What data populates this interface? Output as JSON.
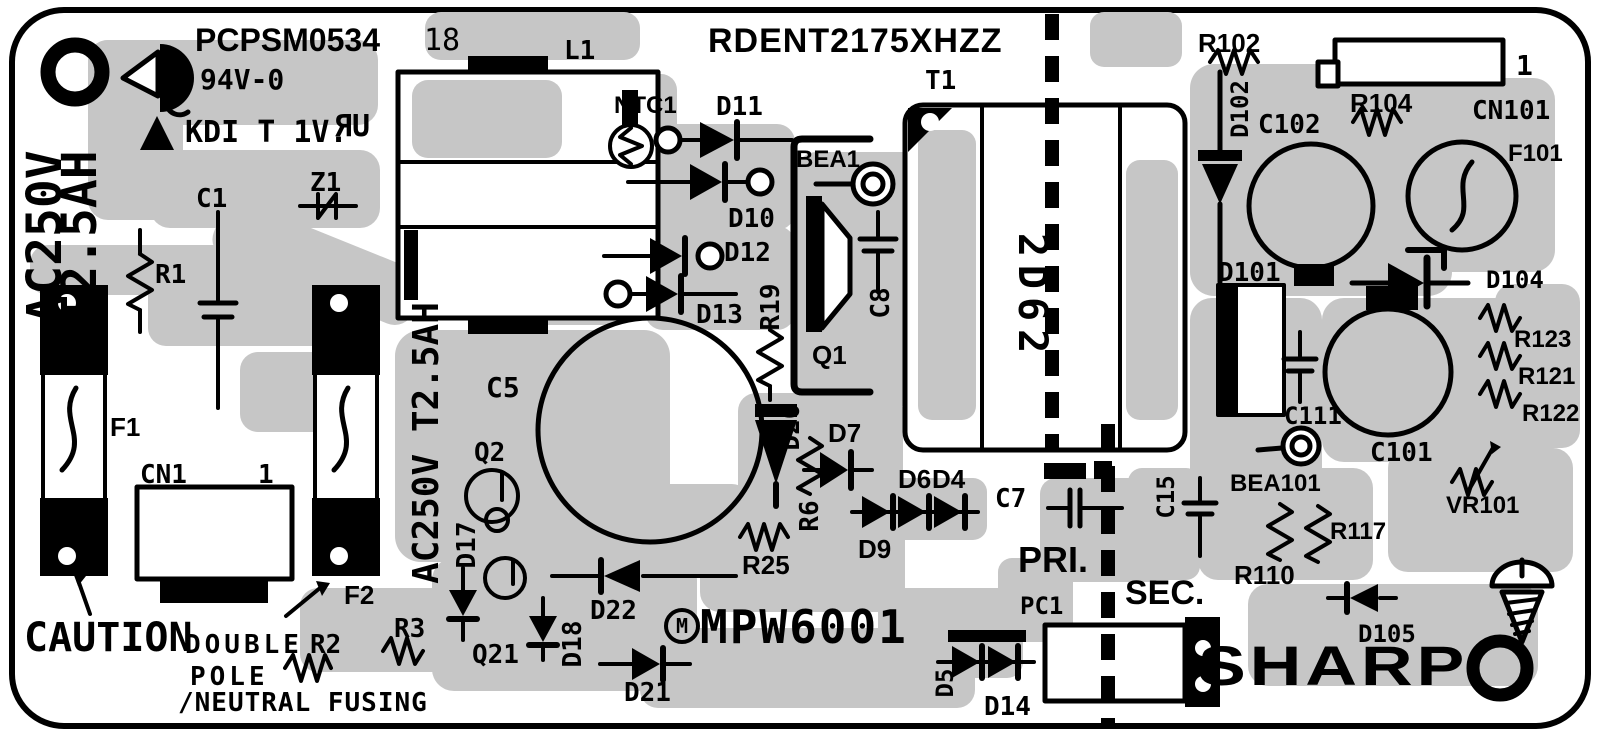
{
  "colors": {
    "copper": "#c6c6c6",
    "silkscreen": "#000000",
    "board": "#ffffff"
  },
  "header": {
    "part_number": "PCPSM0534",
    "revision": "18",
    "flammability_rating": "94V-0",
    "marking": "KDI T 1V.",
    "ul_mark": "ЯU",
    "model": "RDENT2175XHZZ"
  },
  "safety": {
    "caution": "CAUTION",
    "fusing_note_line1": "DOUBLE",
    "fusing_note_line2": "POLE",
    "fusing_note_line3": "/NEUTRAL FUSING",
    "fuse_rating_line1": "AC250V",
    "fuse_rating_line2": "T2.5AH",
    "fuse_rating_inline": "AC250V T2.5AH",
    "primary_side": "PRI.",
    "secondary_side": "SEC."
  },
  "ic": {
    "logo_letter": "M",
    "part": "MPW6001"
  },
  "transformer_marking": "2D62",
  "brand": "SHARP",
  "refs": {
    "c1": "C1",
    "z1": "Z1",
    "r1": "R1",
    "f1": "F1",
    "cn1": "CN1",
    "cn1_pin1": "1",
    "f2": "F2",
    "r2": "R2",
    "r3": "R3",
    "q21": "Q21",
    "d18": "D18",
    "d21": "D21",
    "d22": "D22",
    "d17": "D17",
    "q2": "Q2",
    "c5": "C5",
    "l1": "L1",
    "ntc1": "NTC1",
    "d11": "D11",
    "d10": "D10",
    "d12": "D12",
    "d13": "D13",
    "r19": "R19",
    "bea1": "BEA1",
    "q1": "Q1",
    "c8": "C8",
    "t1": "T1",
    "d20": "D20",
    "d7": "D7",
    "r6": "R6",
    "r25": "R25",
    "d6": "D6",
    "d4": "D4",
    "d9": "D9",
    "c7": "C7",
    "pc1": "PC1",
    "d5": "D5",
    "d14": "D14",
    "c15": "C15",
    "bea101": "BEA101",
    "c111": "C111",
    "c101": "C101",
    "d101": "D101",
    "c102": "C102",
    "d102": "D102",
    "r102": "R102",
    "r104": "R104",
    "cn101": "CN101",
    "cn101_pin1": "1",
    "f101": "F101",
    "d104": "D104",
    "r123": "R123",
    "r121": "R121",
    "r122": "R122",
    "vr101": "VR101",
    "r117": "R117",
    "r110": "R110",
    "d105": "D105"
  }
}
